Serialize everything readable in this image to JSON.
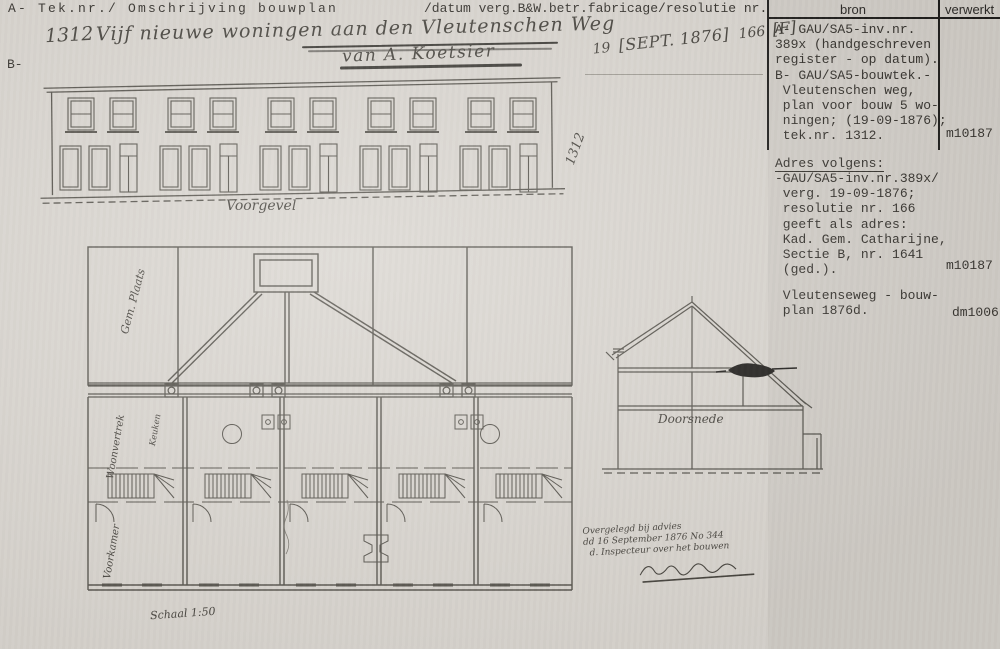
{
  "document": {
    "header_left": "A- Tek.nr./ Omschrijving bouwplan",
    "header_right": "/datum verg.B&W.betr.fabricage/resolutie nr.",
    "section_marker_b": "B-"
  },
  "handwritten": {
    "tek_nr": "1312",
    "title": "Vijf nieuwe woningen aan den Vleutenschen Weg",
    "builder": "van A. Koetsier",
    "date_day": "19",
    "date_stamp": "[SEPT. 1876]",
    "resolutie_nr": "166",
    "stamp_f": "[F]",
    "tek_nr_rotated": "1312",
    "note_line1": "Overgelegd bij advies",
    "note_line2": "dd 16 September 1876 No 344",
    "note_line3": "d. Inspecteur over het bouwen"
  },
  "drawings": {
    "facade_caption": "Voorgevel",
    "section_caption": "Doorsnede",
    "plan_scale": "Schaal 1:50",
    "plan_label_yard": "Gem. Plaats",
    "plan_label_woonvertrek": "Woonvertrek",
    "plan_label_keuken": "Keuken",
    "plan_label_voorkamer": "Voorkamer"
  },
  "source_panel": {
    "col_bron": "bron",
    "col_verwerkt": "verwerkt",
    "entry1_text": "A- GAU/SA5-inv.nr.\n389x (handgeschreven\nregister - op datum).\nB- GAU/SA5-bouwtek.-\n Vleutenschen weg,\n plan voor bouw 5 wo-\n ningen; (19-09-1876);\n tek.nr. 1312.",
    "entry1_verwerkt": "m10187",
    "entry2_heading": "Adres volgens:",
    "entry2_text": "-GAU/SA5-inv.nr.389x/\n verg. 19-09-1876;\n resolutie nr. 166\n geeft als adres:\n Kad. Gem. Catharijne,\n Sectie B, nr. 1641\n (ged.).",
    "entry2_verwerkt": "m10187",
    "entry3_text": " Vleutenseweg - bouw-\n plan 1876d.",
    "entry3_verwerkt": "dm1006"
  },
  "colors": {
    "paper": "#d9d5cf",
    "ink": "#34312c",
    "drawing_line": "#56534c"
  }
}
